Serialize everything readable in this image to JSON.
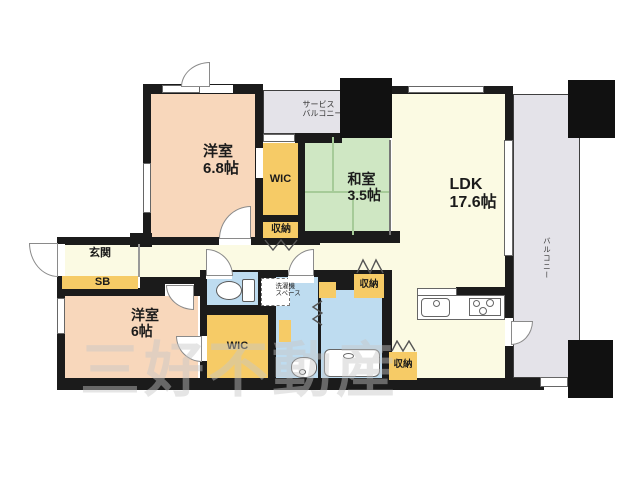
{
  "title": "マンション間取り図",
  "rooms": {
    "bedroom1": {
      "name": "洋室",
      "size": "6.8帖"
    },
    "wic_upper": {
      "name": "WIC"
    },
    "closet_upper": {
      "name": "収納"
    },
    "service_balcony": {
      "line1": "サービス",
      "line2": "バルコニー"
    },
    "washitsu": {
      "name": "和室",
      "size": "3.5帖"
    },
    "ldk": {
      "name": "LDK",
      "size": "17.6帖"
    },
    "balcony": {
      "name": "バルコニー"
    },
    "genkan": {
      "name": "玄関"
    },
    "shoebox": {
      "name": "SB"
    },
    "bedroom2": {
      "name": "洋室",
      "size": "6帖"
    },
    "wic_lower": {
      "name": "WIC"
    },
    "laundry": {
      "line1": "洗濯機",
      "line2": "スペース"
    },
    "closet_hall": {
      "name": "収納"
    },
    "closet_kitchen": {
      "name": "収納"
    }
  },
  "watermark": "三好不動産",
  "icons": {
    "toilet": "toilet-icon",
    "kitchen_sink": "kitchen-sink-icon",
    "stove": "stove-icon",
    "washbasin": "washbasin-icon",
    "bathtub": "bathtub-icon",
    "door_arc": "door-swing-icon",
    "folding_door": "folding-door-icon"
  },
  "colors": {
    "wall": "#1b1b1b",
    "bedroom_fill": "#f8d7bb",
    "tatami_fill": "#cfe7c3",
    "ldk_fill": "#fbfae3",
    "storage_fill": "#f6cb66",
    "sanitary_fill": "#bedcf0",
    "balcony_fill": "#e4e3e9"
  }
}
